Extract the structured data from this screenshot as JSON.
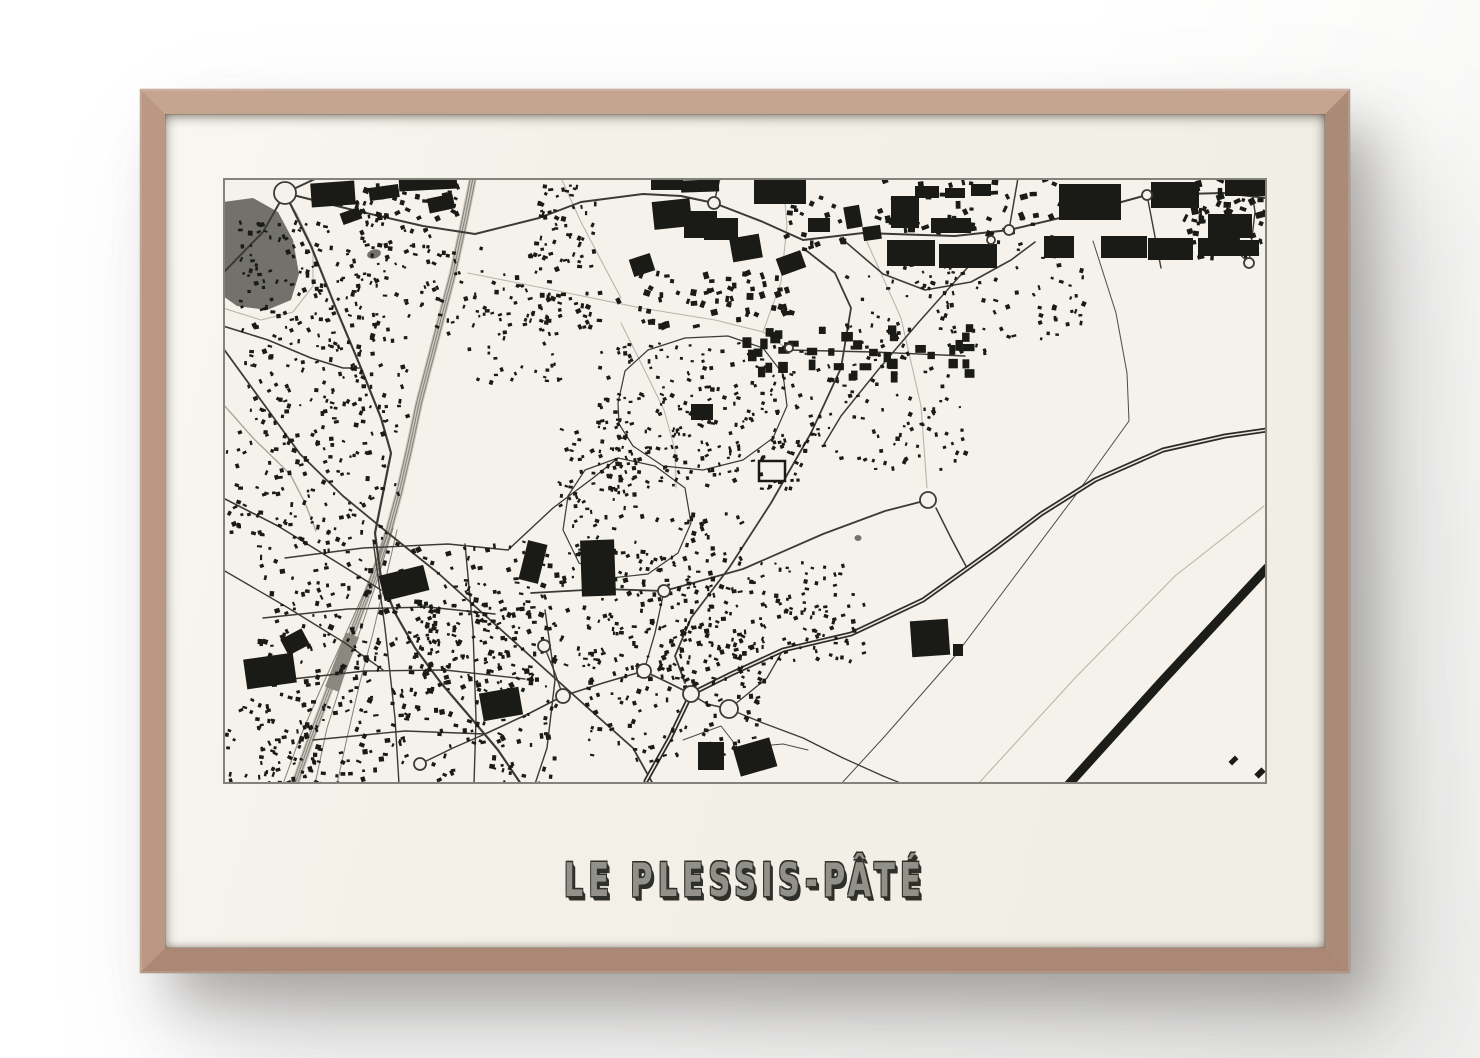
{
  "poster": {
    "title": "LE PLESSIS-PÂTÉ",
    "frame_wood_color": "#c2a08c",
    "mat_color": "#f2f0e7",
    "title_color": "#91918a",
    "title_shadow_color": "#30302b"
  },
  "map": {
    "type": "city-figure-ground-map",
    "background": "#f4f2ea",
    "ink": "#1a1a17",
    "border_color": "#83827b",
    "road_color": "#3b3a34",
    "path_color": "#b9b7ab",
    "rail_color": "#83827a",
    "rail_bed_color": "#cbc9be",
    "water_color": "#73726a",
    "highway_color": "#2b2b27",
    "highway_center_color": "#e9e7dc",
    "runway_color": "#1c1c19",
    "roads": [
      {
        "p": "0,95 40,54 62,15 94,0",
        "w": 2
      },
      {
        "p": "62,15 88,68 112,128 138,190 158,240 168,275 160,315 152,355 158,400 172,435 192,470 218,505 248,540 275,572 298,606",
        "w": 2.2
      },
      {
        "p": "0,170 40,225 77,276 120,318 165,355 215,395 265,440 315,485 365,530 410,570 430,606",
        "w": 1.8
      },
      {
        "p": "0,148 45,162 88,180 120,190 138,190",
        "w": 1.6
      },
      {
        "p": "0,320 55,348 115,385 158,412",
        "w": 1.6
      },
      {
        "p": "0,392 62,428 122,465 160,492",
        "w": 1.4
      },
      {
        "p": "62,15 130,32 200,48 252,56 316,40 358,24 420,16 458,18 491,25 540,44 580,62 640,55 700,57 732,58 786,52 862,34 924,17 1000,15 1044,20",
        "w": 2
      },
      {
        "p": "491,25 497,0",
        "w": 1.5
      },
      {
        "p": "786,52 795,0",
        "w": 1.5
      },
      {
        "p": "924,17 938,90",
        "w": 1.4
      },
      {
        "p": "1026,85 1008,68",
        "w": 1.3
      },
      {
        "p": "1026,85 1032,34 1027,0",
        "w": 1.4
      },
      {
        "p": "580,70 612,95 628,130 618,190 588,255 548,325 506,390 468,440 452,478 462,505",
        "w": 1.8
      },
      {
        "p": "618,60 660,96 702,112 748,104 788,82 812,64",
        "w": 1.6
      },
      {
        "p": "308,415 380,411 441,413 520,391 600,356 662,333 697,324",
        "w": 1.8
      },
      {
        "p": "713,330 728,360 745,392",
        "w": 1.5
      },
      {
        "p": "770,62 735,100 695,145 655,192 618,238 600,268",
        "w": 1.5
      },
      {
        "p": "62,380 140,370 225,366 285,372",
        "w": 1.4
      },
      {
        "p": "40,440 125,431 205,429 272,436",
        "w": 1.4
      },
      {
        "p": "60,502 142,493 222,492 302,501",
        "w": 1.4
      },
      {
        "p": "90,562 182,553 262,556",
        "w": 1.4
      },
      {
        "p": "150,362 162,450 172,540 176,606",
        "w": 1.4
      },
      {
        "p": "242,366 250,452 253,540 251,606",
        "w": 1.4
      },
      {
        "p": "322,432 332,502 324,570 312,606",
        "w": 1.4
      },
      {
        "p": "262,556 305,536 340,518 380,505 421,493 446,505 468,516",
        "w": 1.6
      },
      {
        "p": "321,468 332,495 340,518",
        "w": 1.3
      },
      {
        "p": "421,493 432,455 441,413",
        "w": 1.3
      },
      {
        "p": "197,586 230,570 262,556",
        "w": 1.4
      },
      {
        "p": "285,372 330,330 370,300 395,280",
        "w": 1.4
      },
      {
        "p": "395,225 402,193 425,172 462,160 505,158 540,170 560,196 564,228 550,260 520,282 480,292 440,288 410,268 396,246 395,225",
        "w": 1.2
      },
      {
        "p": "345,318 362,292 395,280 432,288 462,310 468,345 455,375 425,396 388,400 356,385 340,352 345,318",
        "w": 1.2
      },
      {
        "p": "566,172 650,174 742,178",
        "w": 1.4
      }
    ],
    "paths": [
      {
        "p": "0,130 38,142 70,134 90,108 90,70 74,36 62,18",
        "w": 1.1
      },
      {
        "p": "0,226 30,260 67,296 82,325 93,353",
        "w": 1.4,
        "c": "#a9a89d"
      },
      {
        "p": "245,95 330,112 418,130 492,142 540,154",
        "w": 1.1
      },
      {
        "p": "540,154 558,104 564,48 560,0",
        "w": 1.1
      },
      {
        "p": "540,154 566,172",
        "w": 1.1
      },
      {
        "p": "870,63 893,135 904,195 906,243 852,318 792,398 732,478 662,558 618,606",
        "w": 1,
        "c": "#4c4b44"
      },
      {
        "p": "755,606 852,500 952,398 1041,328",
        "w": 1.1
      },
      {
        "p": "398,145 421,191 441,232 452,272 453,310",
        "w": 1.1
      },
      {
        "p": "460,562 498,548 515,570 560,566 585,572",
        "w": 1,
        "c": "#4c4b44"
      },
      {
        "p": "640,55 678,140 698,228 704,310",
        "w": 1.1
      },
      {
        "p": "338,0 358,44 380,86 398,120",
        "w": 1.1
      }
    ],
    "railway": {
      "main": "250,0 242,40 230,95 213,160 196,225 186,272 176,315 166,352 148,406 128,458 106,512 88,560 72,606",
      "offsets": [
        -2.5,
        0,
        2.5
      ],
      "fans": [
        "170,350 155,400 138,450 120,500 104,550 92,606",
        "174,352 162,404 150,455 136,508 124,560 114,606",
        "166,352 144,408 120,462 96,515 76,562 60,606"
      ],
      "bed_w": 8,
      "station_block": [
        112,
        455,
        14,
        58,
        21
      ]
    },
    "highway": {
      "p": "423,603 447,560 468,516 508,496 560,472 628,456 700,422 770,372 818,336 872,302 940,272 1002,258 1044,252",
      "casing_w": 5,
      "center_w": 1.6
    },
    "ramps": [
      {
        "p": "468,516 484,526 506,531",
        "w": 1.5
      },
      {
        "p": "506,531 522,518 544,500 560,472",
        "w": 1.3
      },
      {
        "p": "506,531 540,545 580,560 620,580 660,598 680,606",
        "w": 1.3
      }
    ],
    "runway": {
      "p": "846,606 940,502 1044,390",
      "w": 9
    },
    "water_polys": [
      {
        "pts": "0,24 30,20 55,34 70,62 76,96 68,122 44,132 14,128 0,118"
      }
    ],
    "water_dots": [
      {
        "cx": 151,
        "cy": 76,
        "rx": 7,
        "ry": 4.5,
        "rot": -15
      },
      {
        "cx": 635,
        "cy": 360,
        "rx": 3.5,
        "ry": 3,
        "rot": 0
      }
    ],
    "roundabouts": [
      [
        62,
        15,
        11
      ],
      [
        491,
        25,
        6
      ],
      [
        786,
        52,
        5
      ],
      [
        924,
        17,
        5
      ],
      [
        1026,
        85,
        5
      ],
      [
        705,
        322,
        8
      ],
      [
        441,
        413,
        6
      ],
      [
        468,
        516,
        8
      ],
      [
        506,
        531,
        9
      ],
      [
        340,
        518,
        7
      ],
      [
        421,
        493,
        7
      ],
      [
        321,
        468,
        6
      ],
      [
        197,
        586,
        6
      ],
      [
        768,
        62,
        4
      ],
      [
        566,
        170,
        4
      ]
    ],
    "outlined_buildings": [
      [
        536,
        283,
        26,
        20,
        0
      ]
    ],
    "buildings": [
      [
        88,
        4,
        44,
        24,
        -4
      ],
      [
        146,
        8,
        30,
        13,
        -8
      ],
      [
        176,
        0,
        58,
        12,
        -3
      ],
      [
        205,
        18,
        26,
        15,
        -12
      ],
      [
        118,
        32,
        20,
        12,
        -20
      ],
      [
        408,
        78,
        22,
        18,
        -18
      ],
      [
        428,
        0,
        32,
        12,
        0
      ],
      [
        458,
        2,
        38,
        12,
        -2
      ],
      [
        430,
        22,
        38,
        28,
        -6
      ],
      [
        461,
        33,
        33,
        27,
        0
      ],
      [
        481,
        40,
        34,
        22,
        0
      ],
      [
        508,
        58,
        30,
        24,
        -10
      ],
      [
        531,
        2,
        52,
        24,
        0
      ],
      [
        555,
        76,
        26,
        18,
        -20
      ],
      [
        585,
        40,
        22,
        14,
        0
      ],
      [
        622,
        28,
        16,
        22,
        -10
      ],
      [
        640,
        48,
        18,
        14,
        -8
      ],
      [
        664,
        62,
        48,
        26,
        0
      ],
      [
        716,
        66,
        58,
        24,
        0
      ],
      [
        668,
        18,
        28,
        32,
        0
      ],
      [
        708,
        40,
        40,
        15,
        0
      ],
      [
        692,
        8,
        24,
        12,
        0
      ],
      [
        722,
        10,
        20,
        10,
        0
      ],
      [
        748,
        6,
        20,
        12,
        0
      ],
      [
        836,
        6,
        62,
        36,
        0
      ],
      [
        821,
        58,
        30,
        22,
        0
      ],
      [
        878,
        58,
        46,
        22,
        0
      ],
      [
        928,
        4,
        48,
        26,
        0
      ],
      [
        985,
        36,
        44,
        24,
        0
      ],
      [
        1002,
        2,
        40,
        16,
        0
      ],
      [
        925,
        60,
        45,
        22,
        0
      ],
      [
        975,
        60,
        35,
        18,
        0
      ],
      [
        1008,
        62,
        28,
        16,
        0
      ],
      [
        22,
        478,
        50,
        30,
        -8
      ],
      [
        60,
        455,
        24,
        18,
        -28
      ],
      [
        158,
        392,
        46,
        26,
        -14
      ],
      [
        300,
        364,
        20,
        40,
        14
      ],
      [
        358,
        362,
        34,
        56,
        -2
      ],
      [
        258,
        512,
        40,
        28,
        -10
      ],
      [
        475,
        564,
        26,
        28,
        0
      ],
      [
        513,
        564,
        38,
        30,
        -16
      ],
      [
        688,
        442,
        38,
        36,
        -4
      ],
      [
        730,
        466,
        10,
        12,
        0
      ],
      [
        468,
        226,
        22,
        16,
        0
      ],
      [
        1006,
        580,
        9,
        5,
        -45
      ],
      [
        1032,
        592,
        10,
        6,
        -45
      ]
    ],
    "clusters": [
      [
        15,
        35,
        195,
        105,
        170,
        2,
        5,
        0,
        11
      ],
      [
        18,
        135,
        165,
        120,
        140,
        2,
        5,
        0,
        22
      ],
      [
        108,
        0,
        125,
        38,
        45,
        2.5,
        6,
        0,
        33
      ],
      [
        205,
        62,
        120,
        92,
        55,
        2,
        5,
        0,
        44
      ],
      [
        0,
        252,
        175,
        112,
        130,
        2,
        5,
        0,
        55
      ],
      [
        32,
        362,
        300,
        244,
        430,
        2,
        5.5,
        0,
        66
      ],
      [
        335,
        332,
        185,
        158,
        210,
        2,
        5,
        0,
        77
      ],
      [
        240,
        122,
        100,
        82,
        40,
        2,
        4.5,
        0,
        88
      ],
      [
        372,
        162,
        205,
        148,
        250,
        2,
        4.5,
        0,
        99
      ],
      [
        332,
        242,
        82,
        92,
        70,
        2,
        4.5,
        0,
        110
      ],
      [
        612,
        84,
        150,
        96,
        75,
        2,
        4.5,
        0,
        121
      ],
      [
        580,
        172,
        165,
        118,
        95,
        2,
        4.5,
        0,
        132
      ],
      [
        392,
        92,
        185,
        55,
        60,
        3,
        7,
        0,
        143
      ],
      [
        645,
        0,
        200,
        58,
        55,
        3,
        8,
        0,
        154
      ],
      [
        958,
        0,
        86,
        80,
        55,
        3,
        8,
        0,
        165
      ],
      [
        362,
        442,
        180,
        140,
        170,
        2,
        5,
        0,
        176
      ],
      [
        522,
        382,
        118,
        100,
        95,
        2,
        4.5,
        0,
        187
      ],
      [
        560,
        16,
        60,
        56,
        20,
        3,
        6,
        0,
        198
      ],
      [
        0,
        520,
        118,
        86,
        60,
        2,
        5,
        0,
        209
      ],
      [
        182,
        422,
        140,
        92,
        110,
        2,
        5,
        0,
        220
      ],
      [
        516,
        146,
        230,
        50,
        40,
        6,
        12,
        1,
        231
      ],
      [
        770,
        60,
        90,
        100,
        45,
        2,
        5,
        0,
        242
      ],
      [
        312,
        6,
        60,
        90,
        55,
        2,
        5,
        0,
        253
      ],
      [
        315,
        112,
        60,
        36,
        25,
        2.5,
        5.5,
        0,
        264
      ]
    ]
  }
}
